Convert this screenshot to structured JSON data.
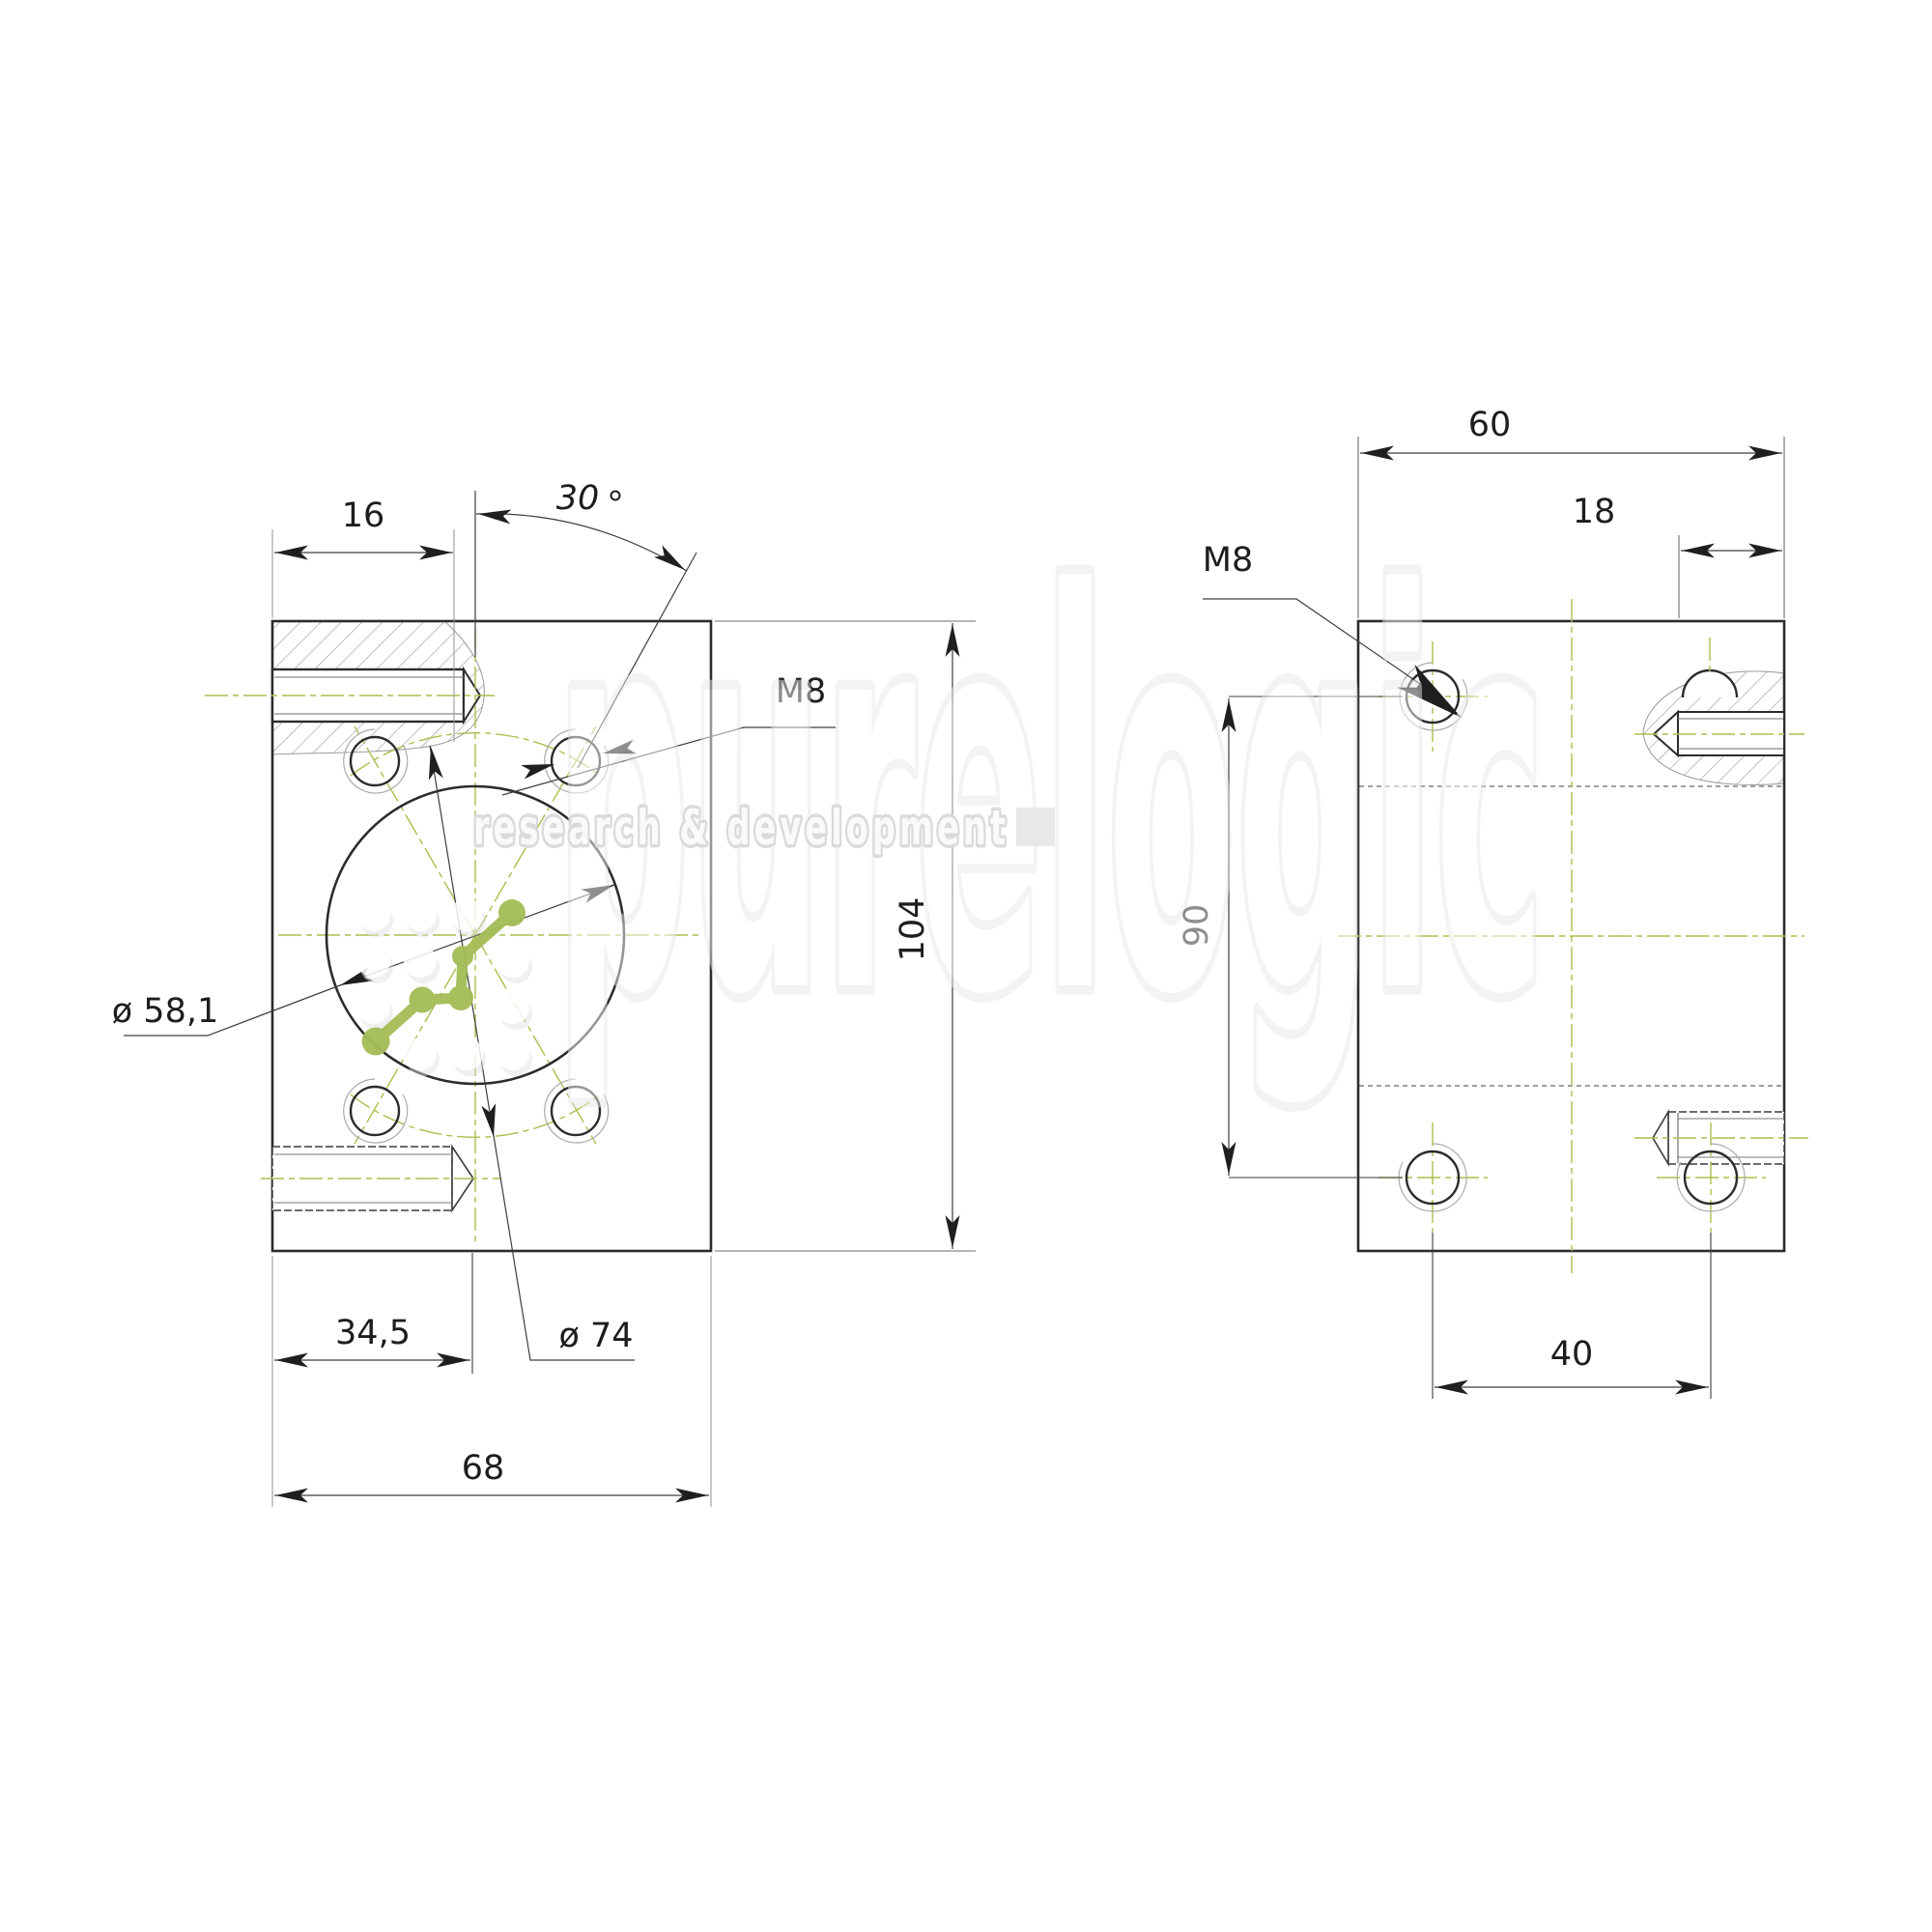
{
  "left_view": {
    "screw_inset": "16",
    "angle": "30",
    "thread_label": "M8",
    "height": "104",
    "bore_diameter": "ø 58,1",
    "bolt_circle_diameter": "ø 74",
    "center_offset": "34,5",
    "width": "68"
  },
  "right_view": {
    "width": "60",
    "edge_offset": "18",
    "thread_label": "M8",
    "hole_row_spacing": "90",
    "hole_col_spacing": "40"
  },
  "watermark": {
    "brand": "purelogic",
    "tagline": "research & development"
  },
  "colors": {
    "line_main": "#2c2c2c",
    "line_thin": "#474747",
    "extension_grey": "#9b9b9b",
    "centerline_green": "#a8c04d",
    "molecule_green": "#a4bd57",
    "watermark_grey": "#e8e8e8"
  }
}
